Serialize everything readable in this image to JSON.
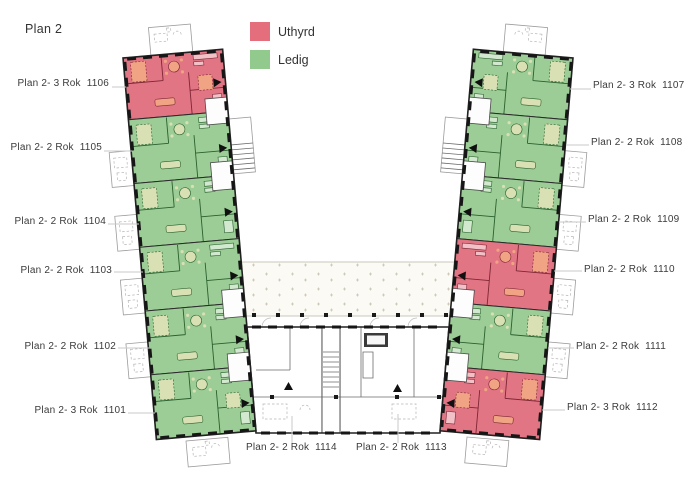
{
  "title": "Plan 2",
  "legend": {
    "items": [
      {
        "key": "uthyrd",
        "label": "Uthyrd",
        "color": "#e56e7d"
      },
      {
        "key": "ledig",
        "label": "Ledig",
        "color": "#92c98c"
      }
    ]
  },
  "floorplan": {
    "statuses": {
      "uthyrd": {
        "fill": "#e17584",
        "wall": "#7e2635",
        "furn": "#f0a483"
      },
      "ledig": {
        "fill": "#9ccd96",
        "wall": "#2a602e",
        "furn": "#d9e0b3"
      },
      "none": {
        "fill": "#ffffff",
        "wall": "#5a5a5a",
        "furn": "#e9e9e9"
      }
    },
    "apartments": [
      {
        "id": "1106",
        "label": "Plan 2- 3 Rok  1106",
        "status": "uthyrd"
      },
      {
        "id": "1105",
        "label": "Plan 2- 2 Rok  1105",
        "status": "ledig"
      },
      {
        "id": "1104",
        "label": "Plan 2- 2 Rok  1104",
        "status": "ledig"
      },
      {
        "id": "1103",
        "label": "Plan 2- 2 Rok  1103",
        "status": "ledig"
      },
      {
        "id": "1102",
        "label": "Plan 2- 2 Rok  1102",
        "status": "ledig"
      },
      {
        "id": "1101",
        "label": "Plan 2- 3 Rok  1101",
        "status": "ledig"
      },
      {
        "id": "1107",
        "label": "Plan 2- 3 Rok  1107",
        "status": "ledig"
      },
      {
        "id": "1108",
        "label": "Plan 2- 2 Rok  1108",
        "status": "ledig"
      },
      {
        "id": "1109",
        "label": "Plan 2- 2 Rok  1109",
        "status": "ledig"
      },
      {
        "id": "1110",
        "label": "Plan 2- 2 Rok  1110",
        "status": "uthyrd"
      },
      {
        "id": "1111",
        "label": "Plan 2- 2 Rok  1111",
        "status": "ledig"
      },
      {
        "id": "1112",
        "label": "Plan 2- 3 Rok  1112",
        "status": "uthyrd"
      },
      {
        "id": "1114",
        "label": "Plan 2- 2 Rok  1114",
        "status": "none"
      },
      {
        "id": "1113",
        "label": "Plan 2- 2 Rok  1113",
        "status": "none"
      }
    ]
  }
}
